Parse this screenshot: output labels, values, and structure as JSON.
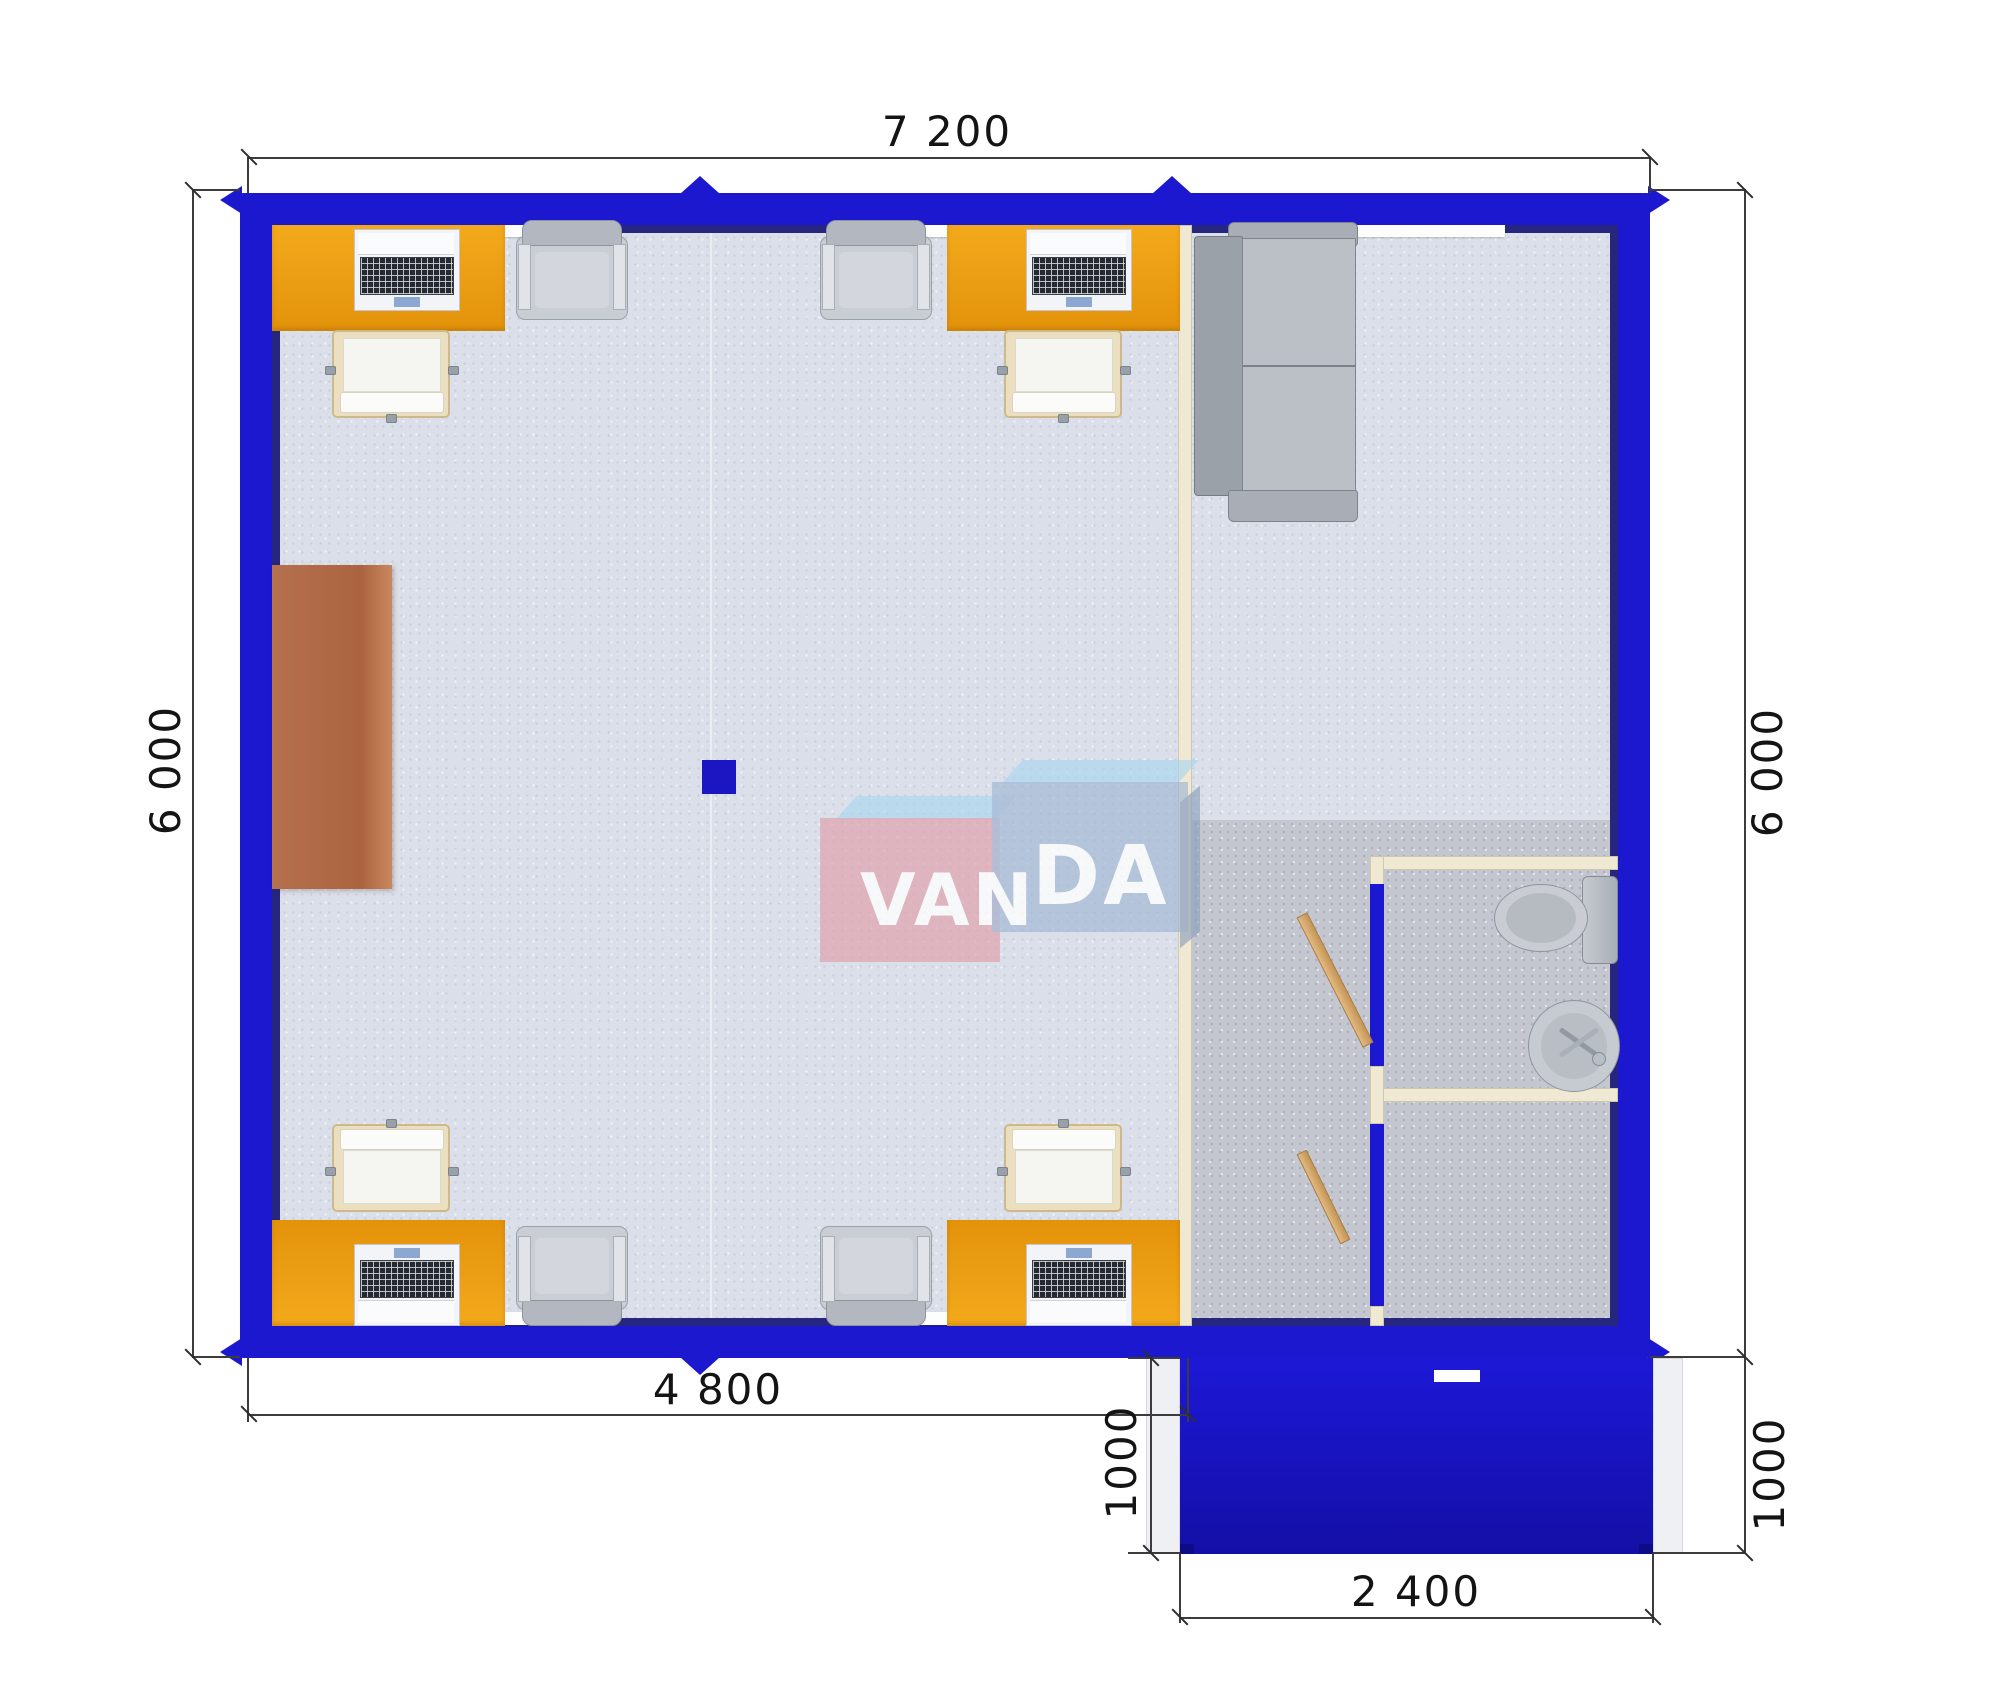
{
  "logo": {
    "van": "VAN",
    "da": "DA"
  },
  "dimensions": {
    "top": "7 200",
    "left": "6 000",
    "right": "6 000",
    "bottom": "4 800",
    "porch_left": "1000",
    "porch_right": "1000",
    "porch_width": "2 400"
  },
  "colors": {
    "wall_blue": "#1c18d0",
    "wall_shadow_navy": "#26267e",
    "desk_orange": "#eea013",
    "floor_light": "#dbdfe9",
    "floor_gray": "#c4c7cf",
    "partition_cream": "#efe8d2",
    "porch_blue": "#1712b0",
    "sideboard_brown": "#b5704e",
    "logo_pink": "#e2a0aa",
    "logo_blue": "#9eb4d2"
  }
}
